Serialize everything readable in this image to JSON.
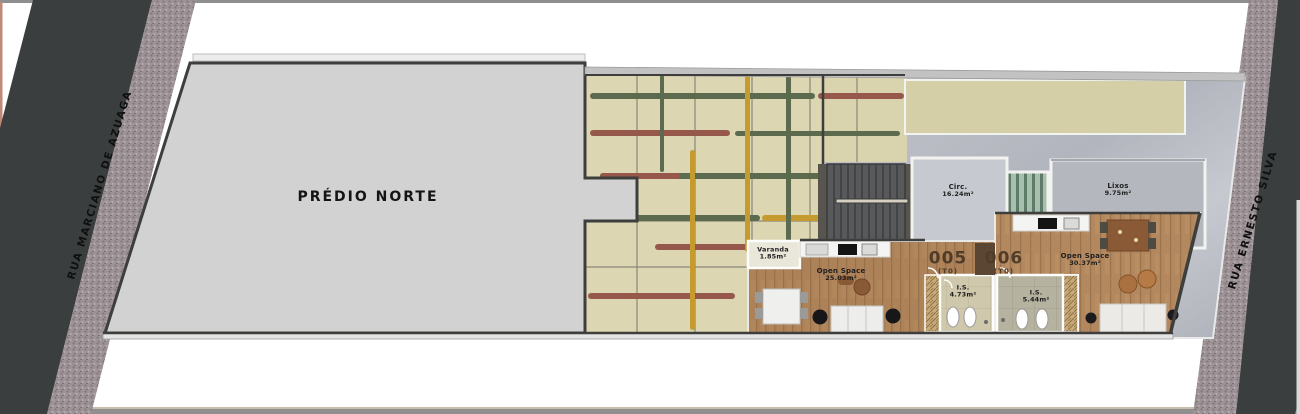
{
  "streets": {
    "left_label": "RUA MARCIANO DE AZUAGA",
    "right_label": "RUA ERNESTO SILVA"
  },
  "building": {
    "label": "PRÉDIO NORTE"
  },
  "units": {
    "u005": {
      "number": "005",
      "type": "(T0)"
    },
    "u006": {
      "number": "006",
      "type": "(T0)"
    }
  },
  "rooms": {
    "circ": {
      "name": "Circ.",
      "area": "16.24m²"
    },
    "lixos": {
      "name": "Lixos",
      "area": "9.75m²"
    },
    "varanda": {
      "name": "Varanda",
      "area": "1.85m²"
    },
    "open_space_005": {
      "name": "Open Space",
      "area": "25.03m²"
    },
    "is_005": {
      "name": "I.S.",
      "area": "4.73m²"
    },
    "is_006": {
      "name": "I.S.",
      "area": "5.44m²"
    },
    "open_space_006": {
      "name": "Open Space",
      "area": "30.37m²"
    }
  },
  "colors": {
    "road": "#3b3e3e",
    "sidewalk": "#9d9396",
    "building_fill": "#d2d2d2",
    "wall": "#3e3e3c",
    "courtyard": "#dcd6b2",
    "marble": "#b9bcc3",
    "wood": "#ad8259",
    "plant_green": "#5c6b4e",
    "plant_red": "#95584a",
    "plant_yellow": "#c59a2e",
    "unit_label": "#503c28"
  }
}
